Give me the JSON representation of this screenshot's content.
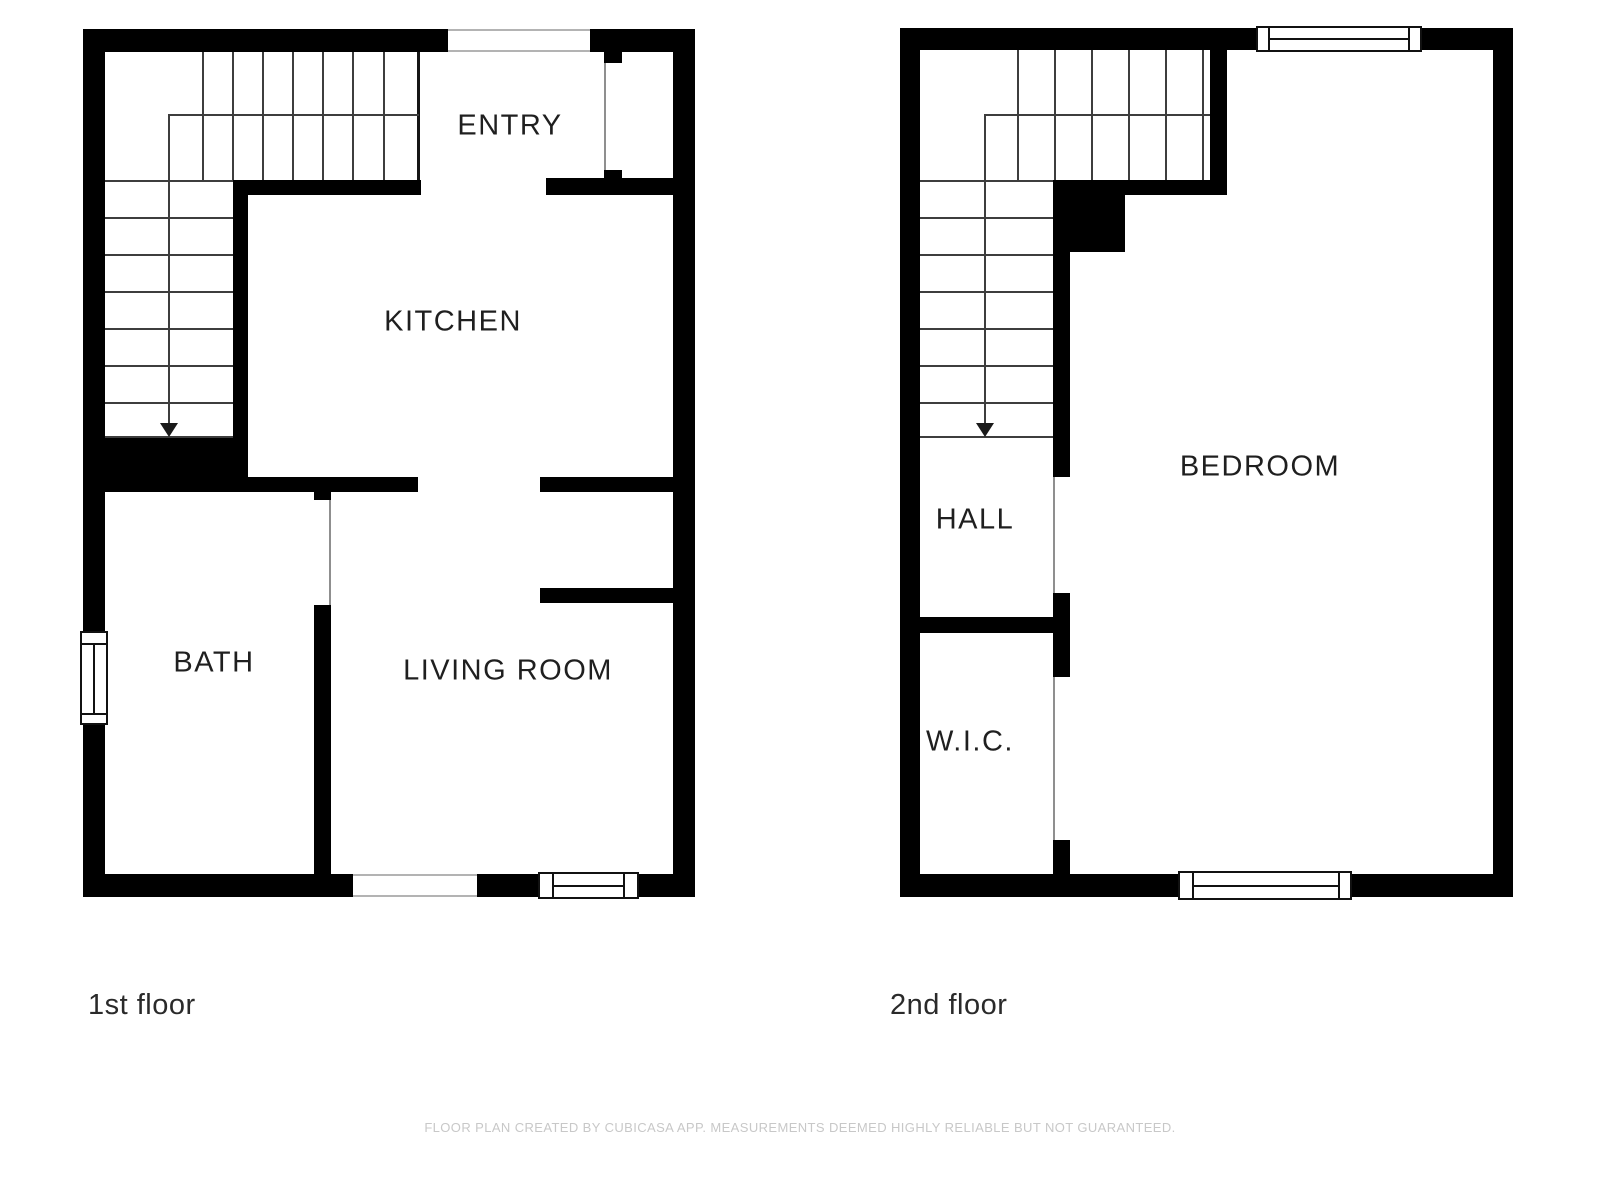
{
  "title": "Floor plan",
  "floors": [
    {
      "label": "1st floor",
      "rooms": [
        {
          "name": "ENTRY"
        },
        {
          "name": "KITCHEN"
        },
        {
          "name": "BATH"
        },
        {
          "name": "LIVING ROOM"
        }
      ]
    },
    {
      "label": "2nd floor",
      "rooms": [
        {
          "name": "BEDROOM"
        },
        {
          "name": "HALL"
        },
        {
          "name": "W.I.C."
        }
      ]
    }
  ],
  "footer": {
    "text": "FLOOR PLAN CREATED BY CUBICASA APP. MEASUREMENTS DEEMED HIGHLY RELIABLE BUT NOT GUARANTEED."
  },
  "colors": {
    "wall": "#000000",
    "background": "#ffffff",
    "label_text": "#1f1f1f",
    "footer_text": "#c8c8c8"
  }
}
